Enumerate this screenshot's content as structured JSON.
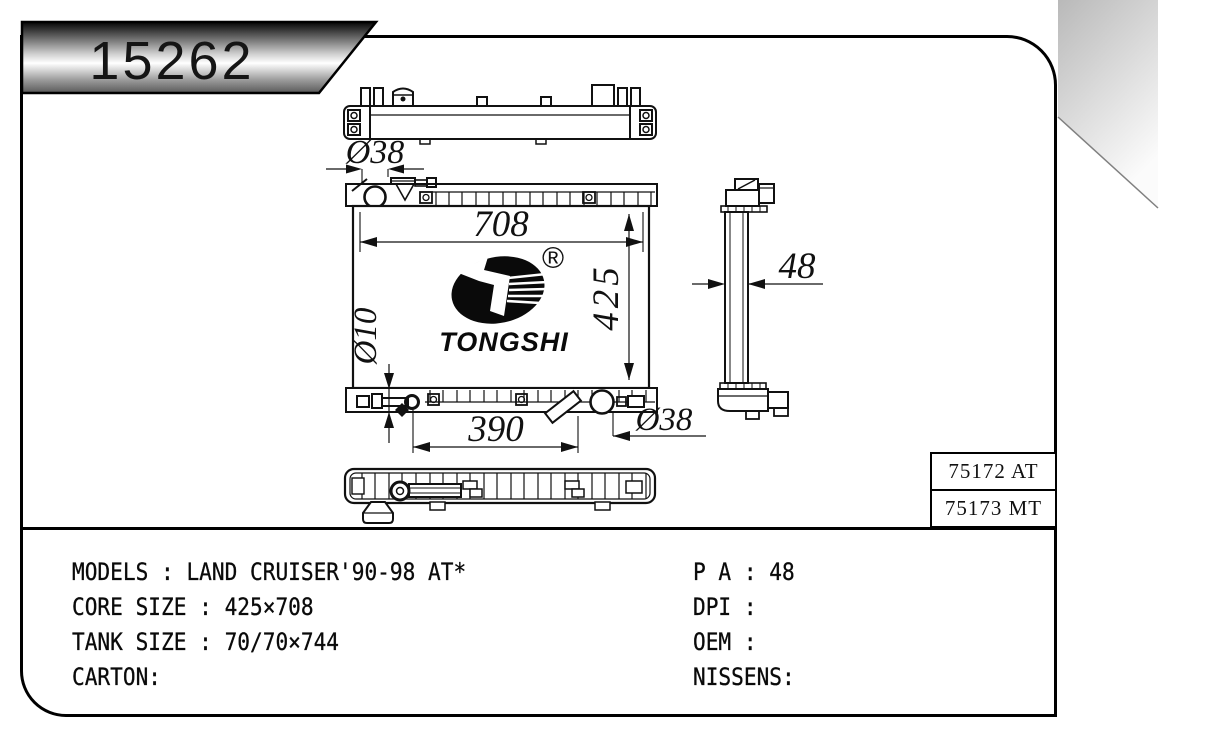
{
  "badge": {
    "part_number": "15262"
  },
  "logo": {
    "registered": "®",
    "wordmark": "TONGSHI"
  },
  "drawing": {
    "dim_top_inlet": "Ø38",
    "dim_core_width": "708",
    "dim_core_height": "425",
    "dim_drain": "Ø10",
    "dim_bottom_span": "390",
    "dim_bottom_outlet": "Ø38",
    "dim_side_width": "48"
  },
  "part_table": {
    "rows": [
      "75172 AT",
      "75173 MT"
    ]
  },
  "specs": {
    "left": [
      "MODELS : LAND CRUISER'90-98 AT*",
      "CORE SIZE : 425×708",
      "TANK SIZE : 70/70×744",
      "CARTON:"
    ],
    "right": [
      "P A : 48",
      "DPI :",
      "OEM :",
      "NISSENS:"
    ]
  }
}
